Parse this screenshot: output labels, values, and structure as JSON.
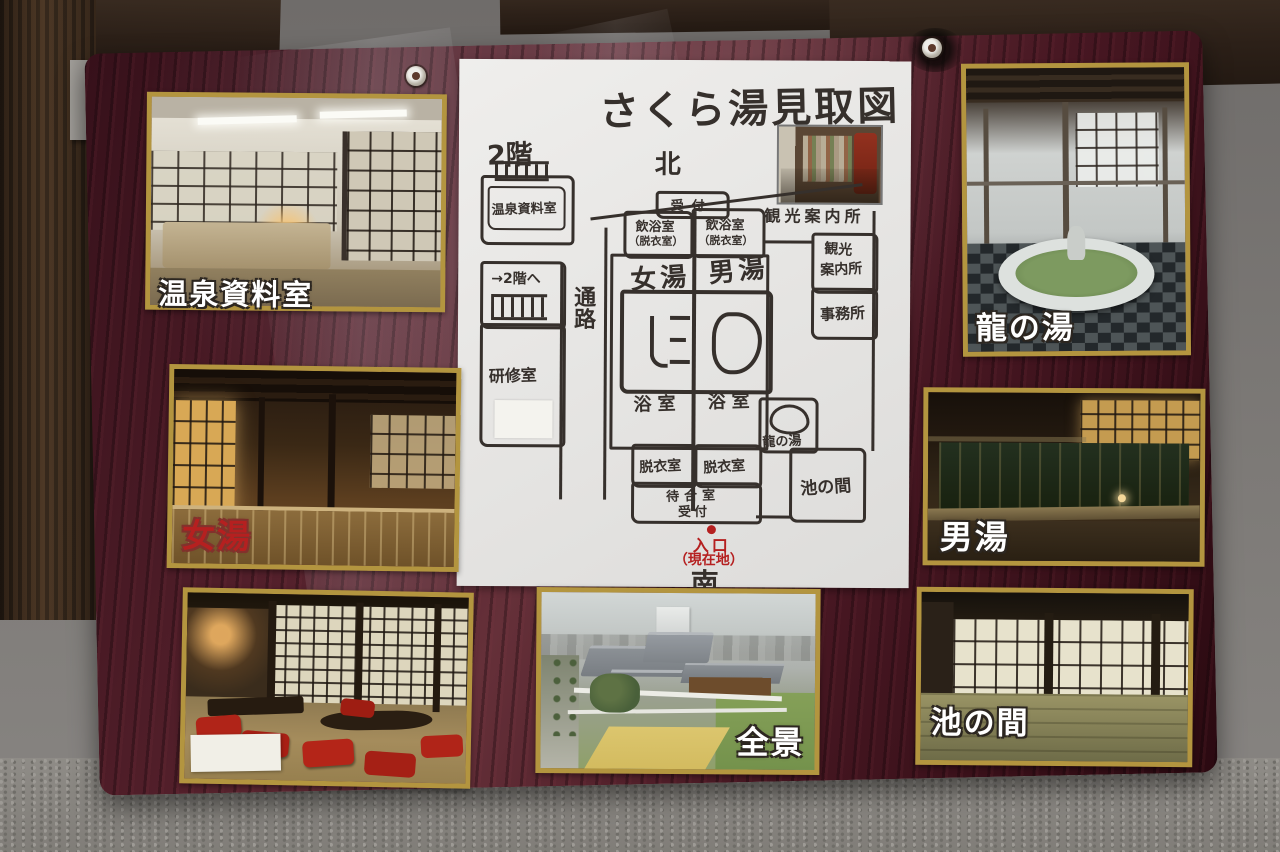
{
  "plan": {
    "title": "さくら湯見取図",
    "compass_north": "北",
    "compass_south": "南",
    "floor2": "2階",
    "onsen_archive_room": "温泉資料室",
    "to_second_floor": "→2階へ",
    "training_room": "研修室",
    "corridor": "通路",
    "reception_top": "受付",
    "drink_bath_room": "飲浴室",
    "drink_bath_room_sub": "（脱衣室）",
    "womens_bath": "女湯",
    "mens_bath": "男湯",
    "bathroom": "浴室",
    "dressing_room": "脱衣室",
    "waiting_room": "待合室",
    "reception_bottom": "受付",
    "tourist_info_line1": "観光",
    "tourist_info_line2": "案内所",
    "office": "事務所",
    "dragon_bath": "龍の湯",
    "pond_room": "池の間",
    "entrance": "入口",
    "you_are_here": "（現在地）",
    "inset_photo_caption": "観光案内所"
  },
  "photo_labels": {
    "archive": "温泉資料室",
    "womens_bath": "女湯",
    "dragon_bath": "龍の湯",
    "mens_bath": "男湯",
    "pond_room": "池の間",
    "panorama": "全景"
  },
  "colors": {
    "board_wood": "#4a1b24",
    "photo_border_gold": "#b3953f",
    "plan_ink": "#36302c",
    "entrance_red": "#b52020"
  }
}
